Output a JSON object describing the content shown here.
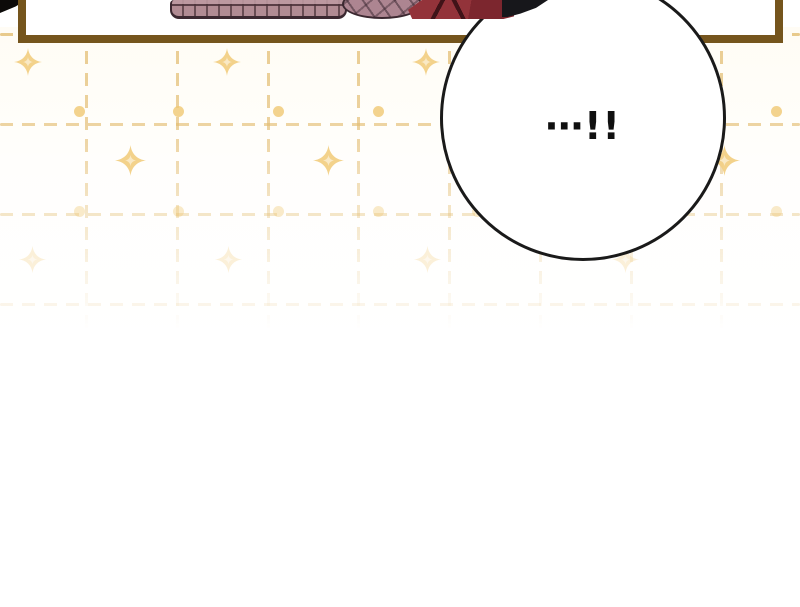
{
  "bubble": {
    "text": "⋯!!"
  },
  "colors": {
    "panel_border": "#75551d",
    "bubble_border": "#1a1a1a",
    "pattern_gold": "#e3bd72",
    "dot_gold": "#f0c873",
    "sparkle_gold": "#f3d086",
    "sweater_mauve": "#b18b93",
    "garment_red": "#8b3038",
    "hair_black": "#17171b"
  },
  "pattern": {
    "dash": {
      "length": 13,
      "gap": 9,
      "thickness": 3
    },
    "h_lines": [
      {
        "y": 33,
        "opacity": 0.8
      },
      {
        "y": 123,
        "opacity": 0.65
      },
      {
        "y": 213,
        "opacity": 0.38
      },
      {
        "y": 303,
        "opacity": 0.15
      }
    ],
    "v_line_xs": [
      85,
      176,
      267,
      357,
      448,
      539,
      630,
      720
    ],
    "dot_xs": [
      79,
      178,
      278,
      378,
      477,
      577,
      676,
      776
    ],
    "dot_rows": [
      {
        "y": 111,
        "opacity": 0.8
      },
      {
        "y": 211,
        "opacity": 0.38
      }
    ],
    "sparkle_rows": [
      {
        "y": 62,
        "size": 28,
        "opacity": 0.95,
        "xs": [
          28,
          227,
          426,
          625
        ]
      },
      {
        "y": 160,
        "size": 31,
        "opacity": 0.95,
        "xs": [
          130,
          328,
          526,
          724
        ]
      },
      {
        "y": 259,
        "size": 27,
        "opacity": 0.3,
        "xs": [
          32,
          228,
          427,
          625
        ]
      }
    ]
  }
}
